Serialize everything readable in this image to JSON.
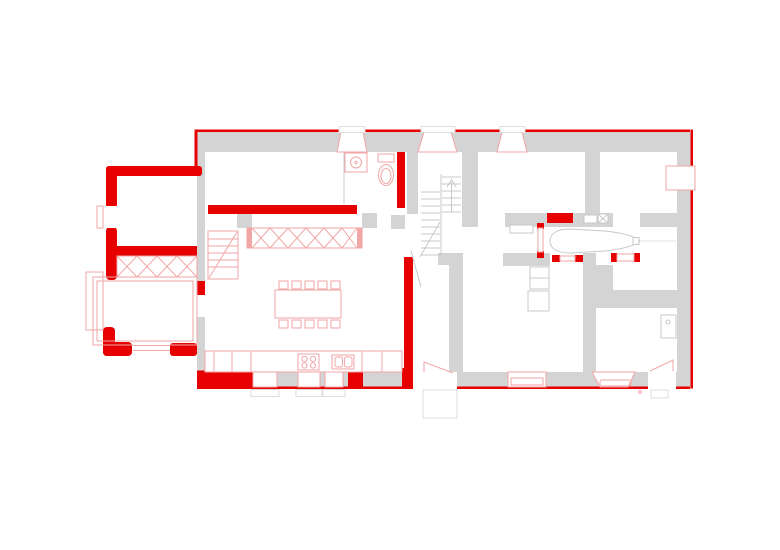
{
  "colors": {
    "accent_red": "#e60000",
    "pale_red": "#f2a6a6",
    "wall_gray": "#d4d4d4",
    "light_gray_line": "#c8c8c8",
    "stoop_gray": "#dedede",
    "background": "#ffffff"
  },
  "drawing": {
    "kind": "floor-plan",
    "dining_chairs_count": 10,
    "cooktop_burners_count": 4,
    "top_wall_windows_count": 3,
    "kitchen_bottom_windows_count": 3
  }
}
